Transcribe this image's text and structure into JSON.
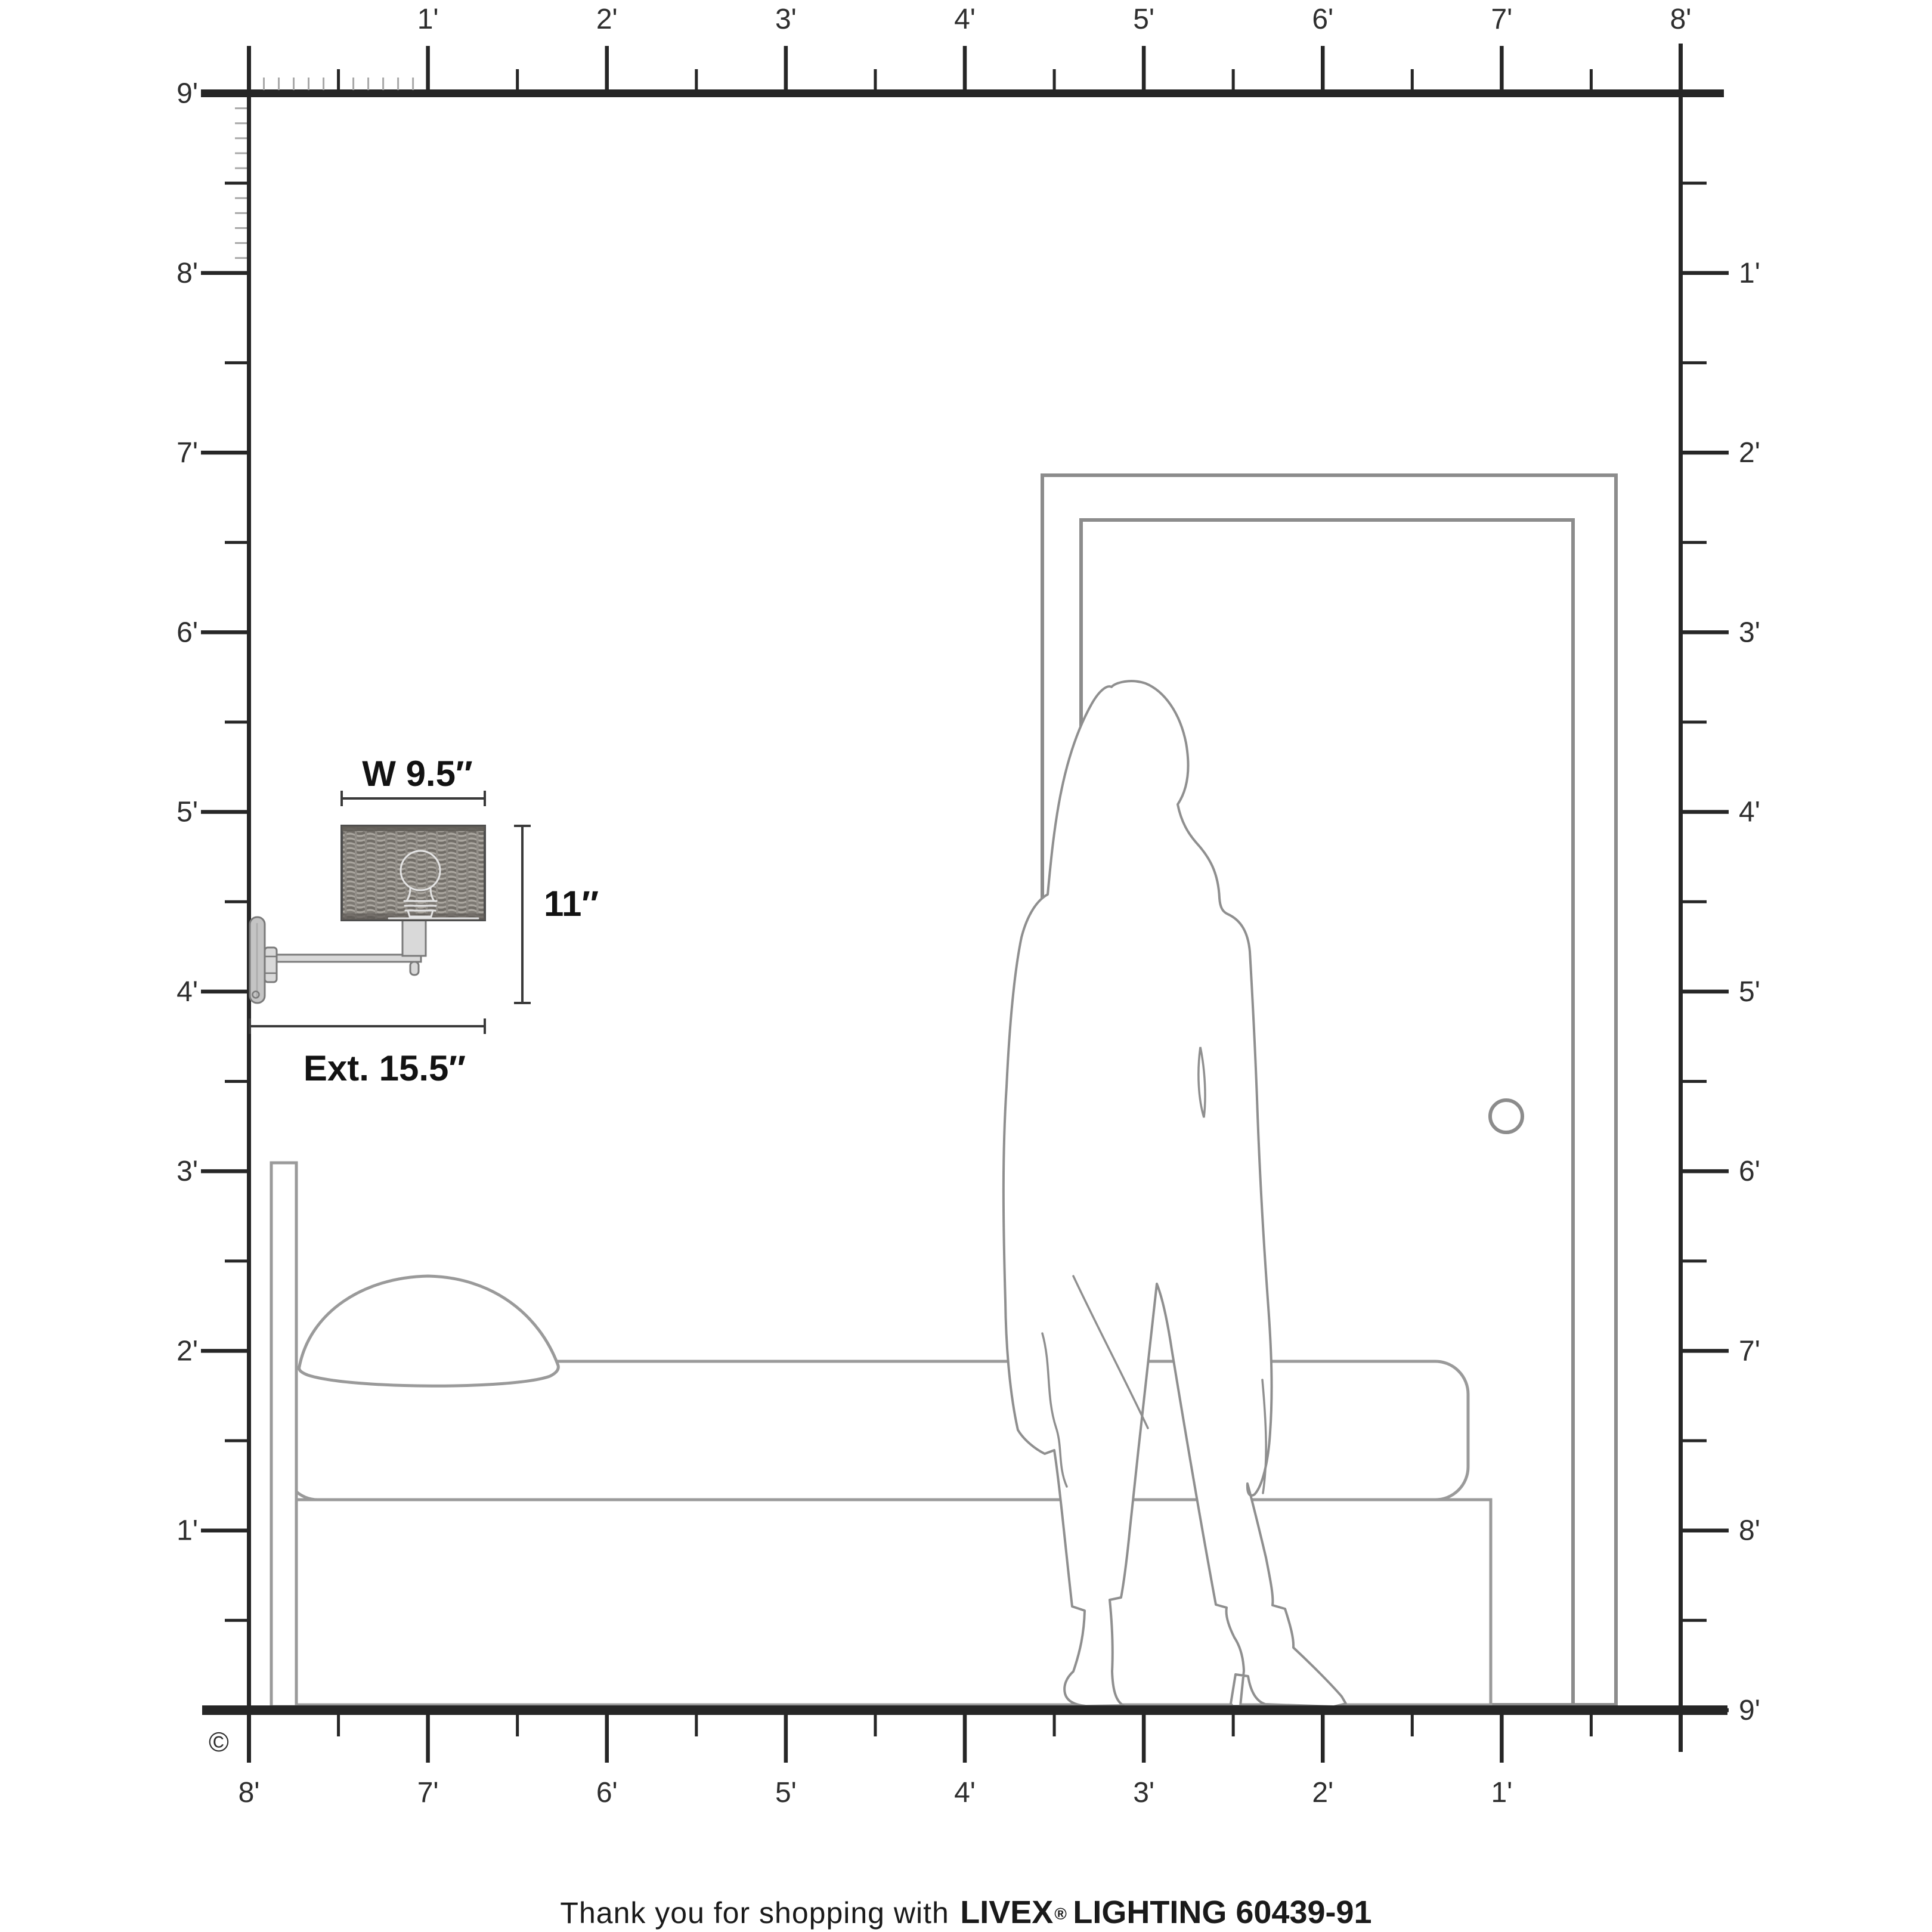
{
  "colors": {
    "ink": "#262626",
    "label": "#2e2e2e",
    "line": "#8c8c8c",
    "tick-minor": "#a8a8a8",
    "dim": "#3a3a3a",
    "dim-text": "#121212",
    "fixture-fill": "#d9d9d9",
    "fixture-stroke": "#7a7a7a",
    "bulb-outline": "#e4e4e4"
  },
  "rulers": {
    "top": {
      "labels": [
        "1'",
        "2'",
        "3'",
        "4'",
        "5'",
        "6'",
        "7'",
        "8'"
      ]
    },
    "bottom": {
      "labels": [
        "8'",
        "7'",
        "6'",
        "5'",
        "4'",
        "3'",
        "2'",
        "1'"
      ]
    },
    "left": {
      "labels": [
        "9'",
        "8'",
        "7'",
        "6'",
        "5'",
        "4'",
        "3'",
        "2'",
        "1'"
      ]
    },
    "right": {
      "labels": [
        "1'",
        "2'",
        "3'",
        "4'",
        "5'",
        "6'",
        "7'",
        "8'",
        "9'"
      ]
    }
  },
  "sconce_dimensions": {
    "width": "W 9.5″",
    "height": "11″",
    "extension": "Ext. 15.5″"
  },
  "copyright_symbol": "©",
  "footer": {
    "prefix": "Thank you for shopping with",
    "brand": "LIVEX",
    "registered": "®",
    "suffix": "LIGHTING 60439-91"
  }
}
